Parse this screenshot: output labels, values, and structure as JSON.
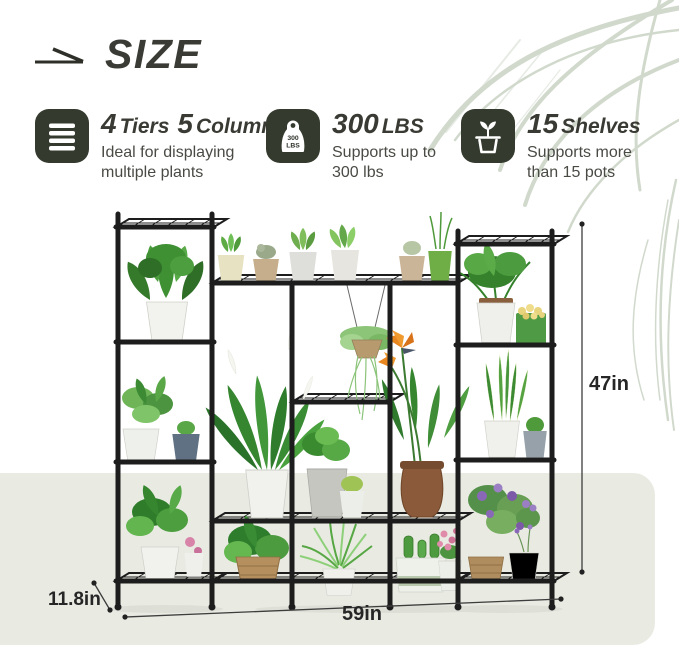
{
  "header": {
    "title": "SIZE",
    "arrow_icon": "right-arrow-icon"
  },
  "features": [
    {
      "icon": "list-icon",
      "num1": "4",
      "word1": "Tiers",
      "num2": "5",
      "word2": "Columns",
      "line1": "Ideal for displaying",
      "line2": "multiple plants"
    },
    {
      "icon": "weight-icon",
      "num1": "300",
      "word1": "LBS",
      "line1": "Supports up to",
      "line2": "300 lbs"
    },
    {
      "icon": "potted-plant-icon",
      "num1": "15",
      "word1": "Shelves",
      "line1": "Supports more",
      "line2": "than 15 pots"
    }
  ],
  "weight_icon_label": {
    "top": "300",
    "bottom": "LBS"
  },
  "dimensions": {
    "height": "47in",
    "width": "59in",
    "depth": "11.8in"
  },
  "colors": {
    "icon_bg": "#343a2d",
    "panel": "#e9ebe3",
    "frame": "#1d1d1d",
    "palm": "#c9d3c4",
    "title_text": "#3a3a34",
    "body_text": "#4a4a45"
  }
}
